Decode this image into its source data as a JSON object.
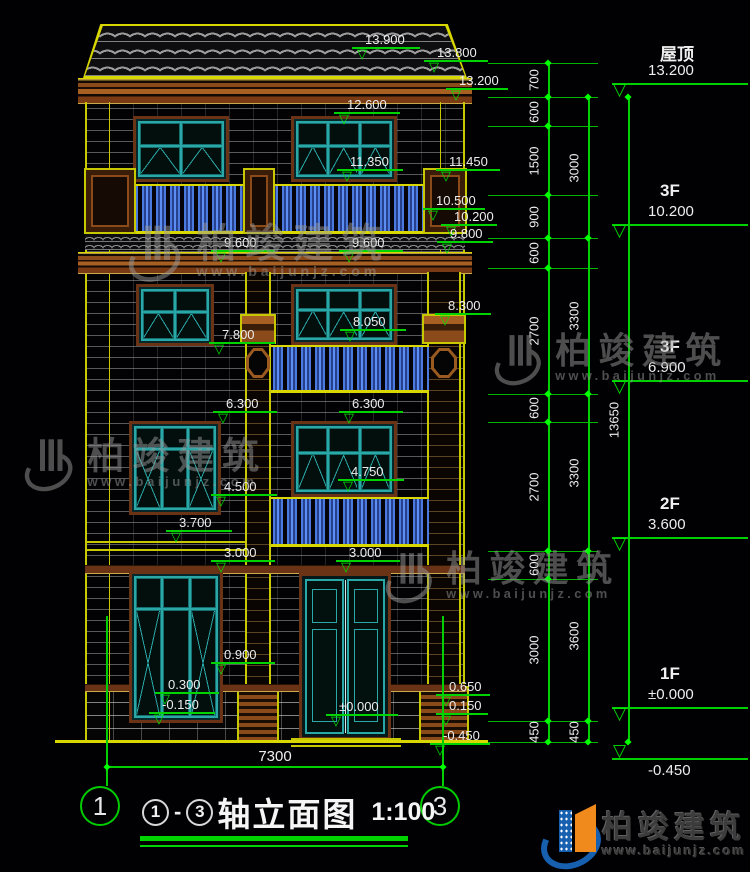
{
  "title": {
    "axis_from": "1",
    "axis_to": "3",
    "text": "轴立面图",
    "scale": "1:100",
    "bottom_dim": "7300",
    "axis_bubble_left": "1",
    "axis_bubble_right": "3"
  },
  "footer_logo": {
    "brand": "柏竣建筑",
    "site": "www.baijunjz.com"
  },
  "watermark": {
    "brand": "柏竣建筑",
    "site": "www.baijunjz.com",
    "positions": [
      {
        "x": 128,
        "y": 220,
        "s": 0.95
      },
      {
        "x": 494,
        "y": 330,
        "s": 0.85
      },
      {
        "x": 24,
        "y": 434,
        "s": 0.88
      },
      {
        "x": 385,
        "y": 548,
        "s": 0.85
      }
    ]
  },
  "facade_markers": [
    {
      "v": "13.900",
      "x": 352,
      "y": 49,
      "w": 68
    },
    {
      "v": "13.800",
      "x": 424,
      "y": 62,
      "w": 64
    },
    {
      "v": "13.200",
      "x": 446,
      "y": 90,
      "w": 62
    },
    {
      "v": "12.600",
      "x": 334,
      "y": 114,
      "w": 66
    },
    {
      "v": "11.350",
      "x": 337,
      "y": 171,
      "w": 66
    },
    {
      "v": "11.450",
      "x": 436,
      "y": 171,
      "w": 64
    },
    {
      "v": "10.500",
      "x": 423,
      "y": 210,
      "w": 62
    },
    {
      "v": "10.200",
      "x": 441,
      "y": 226,
      "w": 56
    },
    {
      "v": "9.800",
      "x": 437,
      "y": 243,
      "w": 56
    },
    {
      "v": "9.600",
      "x": 211,
      "y": 252,
      "w": 64
    },
    {
      "v": "9.600",
      "x": 339,
      "y": 252,
      "w": 64
    },
    {
      "v": "8.300",
      "x": 435,
      "y": 315,
      "w": 56
    },
    {
      "v": "8.050",
      "x": 340,
      "y": 331,
      "w": 66
    },
    {
      "v": "7.800",
      "x": 209,
      "y": 344,
      "w": 66
    },
    {
      "v": "6.300",
      "x": 213,
      "y": 413,
      "w": 64
    },
    {
      "v": "6.300",
      "x": 339,
      "y": 413,
      "w": 64
    },
    {
      "v": "4.750",
      "x": 338,
      "y": 481,
      "w": 66
    },
    {
      "v": "4.500",
      "x": 211,
      "y": 496,
      "w": 66
    },
    {
      "v": "3.700",
      "x": 166,
      "y": 532,
      "w": 66
    },
    {
      "v": "3.000",
      "x": 211,
      "y": 562,
      "w": 64
    },
    {
      "v": "3.000",
      "x": 336,
      "y": 562,
      "w": 64
    },
    {
      "v": "0.900",
      "x": 211,
      "y": 664,
      "w": 64
    },
    {
      "v": "0.300",
      "x": 155,
      "y": 694,
      "w": 64
    },
    {
      "v": "-0.150",
      "x": 149,
      "y": 714,
      "w": 66
    },
    {
      "v": "0.650",
      "x": 436,
      "y": 696,
      "w": 54
    },
    {
      "v": "0.150",
      "x": 436,
      "y": 715,
      "w": 52
    },
    {
      "v": "±0.000",
      "x": 326,
      "y": 716,
      "w": 72
    },
    {
      "v": "-0.450",
      "x": 430,
      "y": 745,
      "w": 60
    }
  ],
  "right_panel": {
    "extension_levels": [
      63,
      97,
      126,
      195,
      238,
      268,
      394,
      422,
      551,
      579,
      721,
      742
    ],
    "floor_levels": [
      97,
      238,
      394,
      551,
      721,
      742
    ],
    "chains": [
      {
        "x": 548,
        "segs": [
          [
            "700",
            63,
            97
          ],
          [
            "600",
            97,
            126
          ],
          [
            "1500",
            126,
            195
          ],
          [
            "900",
            195,
            238
          ],
          [
            "600",
            238,
            268
          ],
          [
            "2700",
            268,
            394
          ],
          [
            "600",
            394,
            422
          ],
          [
            "2700",
            422,
            551
          ],
          [
            "600",
            551,
            579
          ],
          [
            "3000",
            579,
            721
          ],
          [
            "450",
            721,
            742
          ]
        ]
      },
      {
        "x": 588,
        "segs": [
          [
            "3000",
            97,
            238
          ],
          [
            "3300",
            238,
            394
          ],
          [
            "3300",
            394,
            551
          ],
          [
            "3600",
            551,
            721
          ],
          [
            "450",
            721,
            742
          ]
        ]
      },
      {
        "x": 628,
        "segs": [
          [
            "13650",
            97,
            742
          ]
        ]
      }
    ],
    "floors": [
      {
        "name": "屋顶",
        "elev": "13.200",
        "level": 97
      },
      {
        "name": "3F",
        "elev": "10.200",
        "level": 238
      },
      {
        "name": "3F",
        "elev": "6.900",
        "level": 394
      },
      {
        "name": "2F",
        "elev": "3.600",
        "level": 551
      },
      {
        "name": "1F",
        "elev": "±0.000",
        "level": 721
      },
      {
        "name": "",
        "elev": "-0.450",
        "level": 742,
        "below": true
      }
    ]
  }
}
